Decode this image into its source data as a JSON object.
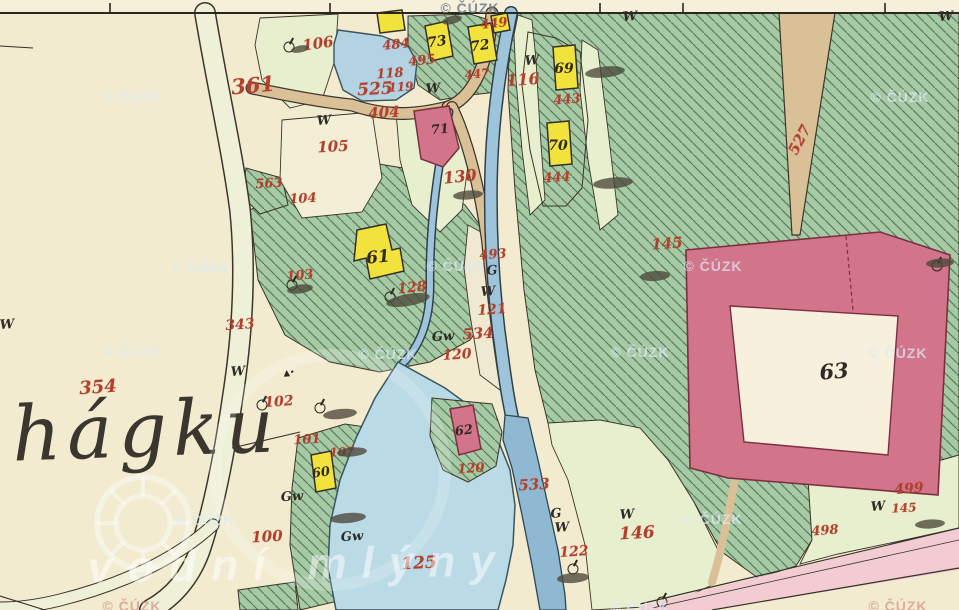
{
  "map": {
    "place_name": "hágku",
    "source_watermark": "© ČÚZK",
    "portal_watermark": "vodní mlýny",
    "colors": {
      "paper": "#f2ebcf",
      "forest_green": "#a6cba4",
      "meadow_green": "#e8efce",
      "water_blue": "#b9d8e4",
      "stream_blue": "#8fb8d2",
      "road_tan": "#d9c096",
      "building_wood": "#f2e23c",
      "building_masonry": "#d2758b",
      "label_red": "#b2402e",
      "label_black": "#2e2a24",
      "highway_pink": "#f2ccd2"
    },
    "border_ticks": [
      110,
      330,
      600,
      683,
      885
    ],
    "parcel_labels": [
      {
        "t": "361",
        "x": 253,
        "y": 85,
        "s": 21,
        "r": -5
      },
      {
        "t": "106",
        "x": 318,
        "y": 44,
        "s": 15,
        "r": -8
      },
      {
        "t": "484",
        "x": 396,
        "y": 45,
        "s": 13,
        "r": -6
      },
      {
        "t": "495",
        "x": 422,
        "y": 61,
        "s": 13,
        "r": -6
      },
      {
        "t": "118",
        "x": 390,
        "y": 74,
        "s": 13,
        "r": -4
      },
      {
        "t": "119",
        "x": 401,
        "y": 87,
        "s": 12,
        "r": -4
      },
      {
        "t": "525",
        "x": 375,
        "y": 90,
        "s": 17,
        "r": -3
      },
      {
        "t": "404",
        "x": 384,
        "y": 113,
        "s": 15,
        "r": -3
      },
      {
        "t": "449",
        "x": 494,
        "y": 24,
        "s": 13,
        "r": -6
      },
      {
        "t": "447",
        "x": 477,
        "y": 74,
        "s": 12,
        "r": -6
      },
      {
        "t": "116",
        "x": 523,
        "y": 80,
        "s": 16,
        "r": -4
      },
      {
        "t": "443",
        "x": 567,
        "y": 100,
        "s": 13,
        "r": -4
      },
      {
        "t": "444",
        "x": 557,
        "y": 178,
        "s": 13,
        "r": -4
      },
      {
        "t": "130",
        "x": 460,
        "y": 177,
        "s": 16,
        "r": -6
      },
      {
        "t": "105",
        "x": 333,
        "y": 147,
        "s": 15,
        "r": -3
      },
      {
        "t": "563",
        "x": 269,
        "y": 184,
        "s": 13,
        "r": -3
      },
      {
        "t": "104",
        "x": 303,
        "y": 199,
        "s": 13,
        "r": -3
      },
      {
        "t": "103",
        "x": 300,
        "y": 276,
        "s": 13,
        "r": -6
      },
      {
        "t": "343",
        "x": 240,
        "y": 325,
        "s": 14,
        "r": -4
      },
      {
        "t": "354",
        "x": 98,
        "y": 388,
        "s": 18,
        "r": -4
      },
      {
        "t": "128",
        "x": 412,
        "y": 288,
        "s": 14,
        "r": -6
      },
      {
        "t": "493",
        "x": 493,
        "y": 255,
        "s": 13,
        "r": -4
      },
      {
        "t": "121",
        "x": 492,
        "y": 310,
        "s": 14,
        "r": -4
      },
      {
        "t": "534",
        "x": 478,
        "y": 334,
        "s": 15,
        "r": -3
      },
      {
        "t": "120",
        "x": 457,
        "y": 355,
        "s": 14,
        "r": -4
      },
      {
        "t": "102",
        "x": 279,
        "y": 402,
        "s": 14,
        "r": -4
      },
      {
        "t": "101",
        "x": 307,
        "y": 440,
        "s": 13,
        "r": -3
      },
      {
        "t": "107",
        "x": 342,
        "y": 452,
        "s": 12,
        "r": -3
      },
      {
        "t": "100",
        "x": 267,
        "y": 537,
        "s": 15,
        "r": -3
      },
      {
        "t": "125",
        "x": 419,
        "y": 564,
        "s": 17,
        "r": -3
      },
      {
        "t": "120",
        "x": 471,
        "y": 469,
        "s": 13,
        "r": -4
      },
      {
        "t": "533",
        "x": 534,
        "y": 485,
        "s": 15,
        "r": -3
      },
      {
        "t": "122",
        "x": 574,
        "y": 552,
        "s": 14,
        "r": -4
      },
      {
        "t": "146",
        "x": 637,
        "y": 534,
        "s": 17,
        "r": -3
      },
      {
        "t": "145",
        "x": 667,
        "y": 244,
        "s": 15,
        "r": -4
      },
      {
        "t": "527",
        "x": 800,
        "y": 140,
        "s": 15,
        "r": -62
      },
      {
        "t": "499",
        "x": 909,
        "y": 489,
        "s": 14,
        "r": -4
      },
      {
        "t": "145",
        "x": 904,
        "y": 508,
        "s": 12,
        "r": -3
      },
      {
        "t": "498",
        "x": 825,
        "y": 531,
        "s": 13,
        "r": -4
      }
    ],
    "building_labels": [
      {
        "t": "73",
        "x": 437,
        "y": 42,
        "s": 14,
        "r": -8
      },
      {
        "t": "72",
        "x": 480,
        "y": 46,
        "s": 14,
        "r": -8
      },
      {
        "t": "69",
        "x": 564,
        "y": 69,
        "s": 14,
        "r": 0
      },
      {
        "t": "70",
        "x": 558,
        "y": 146,
        "s": 14,
        "r": 0
      },
      {
        "t": "71",
        "x": 440,
        "y": 130,
        "s": 13,
        "r": -6
      },
      {
        "t": "61",
        "x": 378,
        "y": 258,
        "s": 17,
        "r": -6
      },
      {
        "t": "60",
        "x": 321,
        "y": 473,
        "s": 13,
        "r": -8
      },
      {
        "t": "62",
        "x": 464,
        "y": 431,
        "s": 13,
        "r": -8
      },
      {
        "t": "63",
        "x": 834,
        "y": 371,
        "s": 21,
        "r": -5
      }
    ],
    "culture_marks": [
      {
        "t": "W",
        "x": 532,
        "y": 61
      },
      {
        "t": "W",
        "x": 433,
        "y": 89
      },
      {
        "t": "W",
        "x": 630,
        "y": 17
      },
      {
        "t": "W",
        "x": 946,
        "y": 17
      },
      {
        "t": "W",
        "x": 324,
        "y": 121
      },
      {
        "t": "W",
        "x": 238,
        "y": 372
      },
      {
        "t": "W",
        "x": 7,
        "y": 325
      },
      {
        "t": "G",
        "x": 492,
        "y": 271
      },
      {
        "t": "W",
        "x": 488,
        "y": 292
      },
      {
        "t": "Gw",
        "x": 443,
        "y": 337
      },
      {
        "t": "Gw",
        "x": 292,
        "y": 497
      },
      {
        "t": "Gw",
        "x": 352,
        "y": 537
      },
      {
        "t": "G",
        "x": 556,
        "y": 514
      },
      {
        "t": "W",
        "x": 562,
        "y": 528
      },
      {
        "t": "W",
        "x": 627,
        "y": 515
      },
      {
        "t": "W",
        "x": 878,
        "y": 507
      },
      {
        "t": "▴·",
        "x": 289,
        "y": 373
      }
    ],
    "watermarks": [
      {
        "x": 470,
        "y": 8,
        "tone": "dark"
      },
      {
        "x": 132,
        "y": 96,
        "tone": "light"
      },
      {
        "x": 900,
        "y": 97,
        "tone": "light"
      },
      {
        "x": 200,
        "y": 267,
        "tone": "light"
      },
      {
        "x": 456,
        "y": 266,
        "tone": "light"
      },
      {
        "x": 713,
        "y": 266,
        "tone": "light"
      },
      {
        "x": 132,
        "y": 351,
        "tone": "light"
      },
      {
        "x": 388,
        "y": 354,
        "tone": "light"
      },
      {
        "x": 640,
        "y": 352,
        "tone": "light"
      },
      {
        "x": 898,
        "y": 353,
        "tone": "light"
      },
      {
        "x": 205,
        "y": 520,
        "tone": "light"
      },
      {
        "x": 713,
        "y": 519,
        "tone": "light"
      },
      {
        "x": 132,
        "y": 606,
        "tone": "red"
      },
      {
        "x": 640,
        "y": 607,
        "tone": "light"
      },
      {
        "x": 898,
        "y": 606,
        "tone": "red"
      }
    ],
    "trees": [
      {
        "x": 292,
        "y": 285
      },
      {
        "x": 262,
        "y": 405
      },
      {
        "x": 320,
        "y": 408
      },
      {
        "x": 573,
        "y": 569
      },
      {
        "x": 662,
        "y": 602
      },
      {
        "x": 937,
        "y": 266
      },
      {
        "x": 390,
        "y": 297
      },
      {
        "x": 289,
        "y": 47
      }
    ],
    "smudges": [
      {
        "x": 408,
        "y": 300,
        "w": 44,
        "h": 12,
        "r": -10
      },
      {
        "x": 300,
        "y": 289,
        "w": 26,
        "h": 9,
        "r": -8
      },
      {
        "x": 605,
        "y": 72,
        "w": 40,
        "h": 11,
        "r": -6
      },
      {
        "x": 613,
        "y": 183,
        "w": 40,
        "h": 11,
        "r": -5
      },
      {
        "x": 655,
        "y": 276,
        "w": 30,
        "h": 10,
        "r": -4
      },
      {
        "x": 468,
        "y": 195,
        "w": 30,
        "h": 9,
        "r": -5
      },
      {
        "x": 340,
        "y": 414,
        "w": 34,
        "h": 10,
        "r": -6
      },
      {
        "x": 352,
        "y": 452,
        "w": 30,
        "h": 9,
        "r": -5
      },
      {
        "x": 348,
        "y": 518,
        "w": 36,
        "h": 10,
        "r": -5
      },
      {
        "x": 930,
        "y": 524,
        "w": 30,
        "h": 9,
        "r": -4
      },
      {
        "x": 940,
        "y": 263,
        "w": 28,
        "h": 9,
        "r": -4
      },
      {
        "x": 573,
        "y": 578,
        "w": 32,
        "h": 10,
        "r": -4
      },
      {
        "x": 300,
        "y": 49,
        "w": 18,
        "h": 7,
        "r": -12
      },
      {
        "x": 452,
        "y": 20,
        "w": 20,
        "h": 8,
        "r": -14
      }
    ]
  }
}
